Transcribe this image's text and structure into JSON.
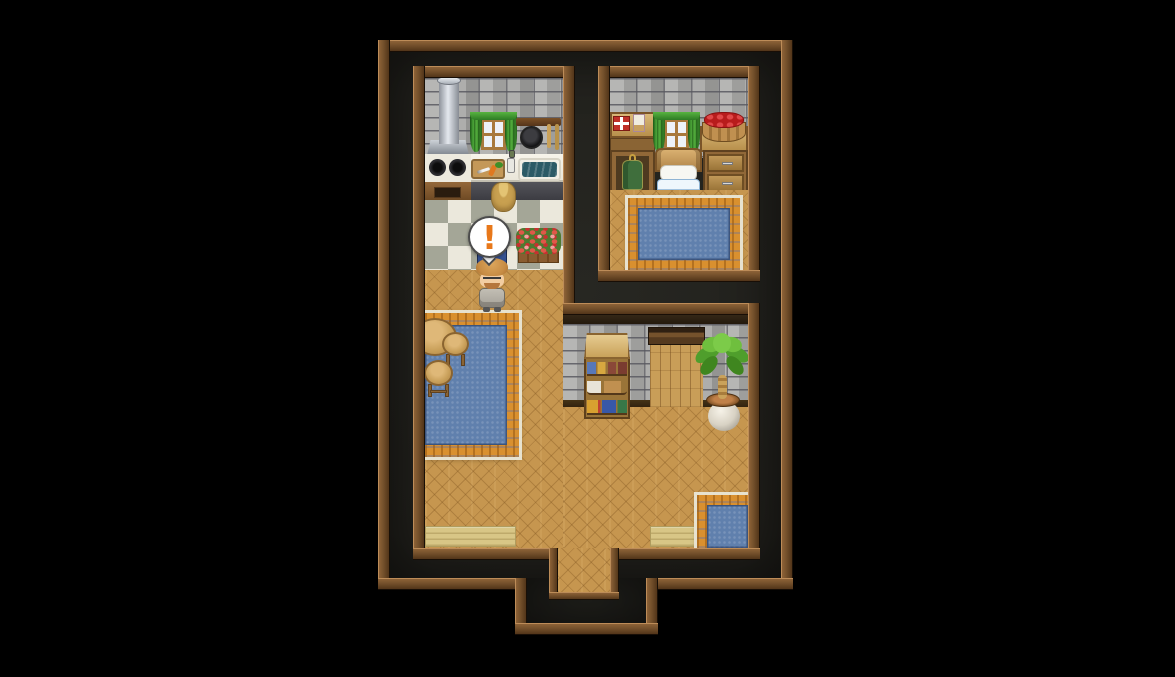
{
  "scene": {
    "description": "Top-down pixel-art RPG interior map of a house (kitchen, bedroom, living room) surrounded by black",
    "background_color": "#000000",
    "map_frame_color": "#74502b",
    "out_of_bounds_color": "#232220"
  },
  "balloon": {
    "symbol": "!",
    "symbol_color": "#e8781a",
    "bubble_color": "#ffffff"
  },
  "character": {
    "name": "villager",
    "facing": "down",
    "hair_color": "#c78c44",
    "skin_color": "#f2cda2",
    "outfit_color": "#b3afa6",
    "accessories": [
      "glasses",
      "beard"
    ]
  },
  "palette": {
    "brick_wall": "#a6a6a4",
    "parquet_floor": "#c6964f",
    "checker_light": "#ebe8dc",
    "checker_dark": "#a4a697",
    "rug_blue": "#6080ad",
    "rug_orange": "#d9902f",
    "curtain_green": "#3f9a33",
    "sink_water": "#2c5a66",
    "doormat": "#d8c686",
    "bed_blanket": "#bedaf0"
  },
  "rooms": [
    {
      "id": "kitchen",
      "objects": [
        "chimney-pipe",
        "range-hood",
        "window-green-curtains",
        "utensil-rack",
        "frying-pan",
        "stove-two-burners",
        "oven-cabinet",
        "cutting-board",
        "spice-jars",
        "sink",
        "grain-sack",
        "checkered-floor",
        "flower-box",
        "book-stand",
        "exclamation-balloon",
        "villager"
      ]
    },
    {
      "id": "bedroom",
      "objects": [
        "gift-box",
        "postcard",
        "window-green-curtains",
        "apple-basket",
        "wardrobe-with-tunic",
        "bed",
        "drawer-chest",
        "blue-rug"
      ]
    },
    {
      "id": "living-room",
      "objects": [
        "round-table",
        "stool",
        "stool",
        "large-blue-rug",
        "storage-shelf",
        "doorway-opening",
        "potted-plant",
        "small-blue-rug",
        "doormat-left",
        "doormat-right",
        "exit-passage"
      ]
    }
  ]
}
